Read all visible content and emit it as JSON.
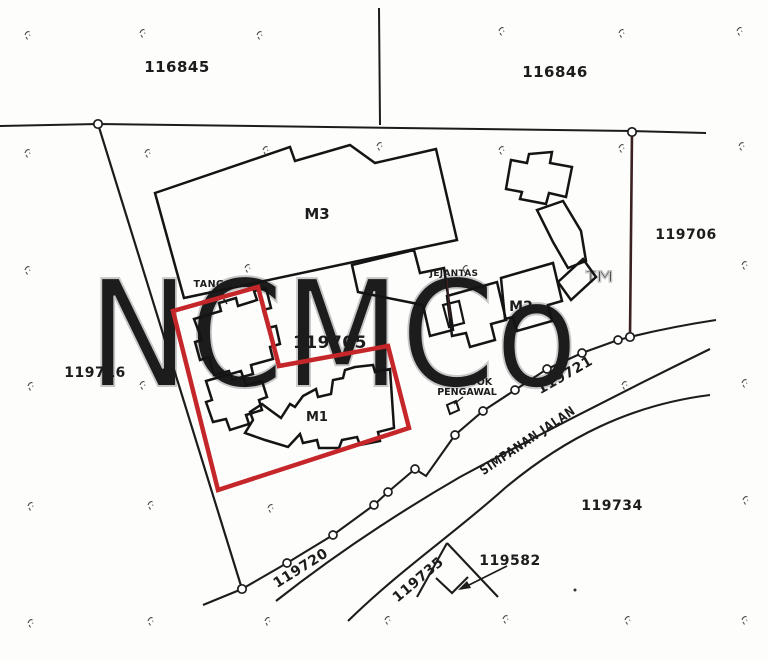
{
  "map_labels": {
    "lot_116845": "116845",
    "lot_116846": "116846",
    "lot_119706": "119706",
    "lot_119716": "119716",
    "lot_119705": "119705",
    "lot_119720": "119720",
    "lot_119721": "119721",
    "lot_119734": "119734",
    "lot_119735": "119735",
    "lot_119582": "119582",
    "building_m1": "M1",
    "building_m2": "M2",
    "building_m3": "M3",
    "annotation_tangga": "TANGGA",
    "annotation_jejantas": "JEJANTAS",
    "annotation_pondok_line1": "PONDOK",
    "annotation_pondok_line2": "PENGAWAL",
    "road_name": "SIMPANAN JALAN"
  },
  "watermark": {
    "text": "NCMCo",
    "symbol": "™"
  },
  "colors": {
    "highlight_red": "#c5262a",
    "ink_black": "#1c1c1c",
    "boundary_maroon": "#3b2121",
    "watermark_gray": "#c7c7c7",
    "paper_white": "#fdfdfb"
  }
}
